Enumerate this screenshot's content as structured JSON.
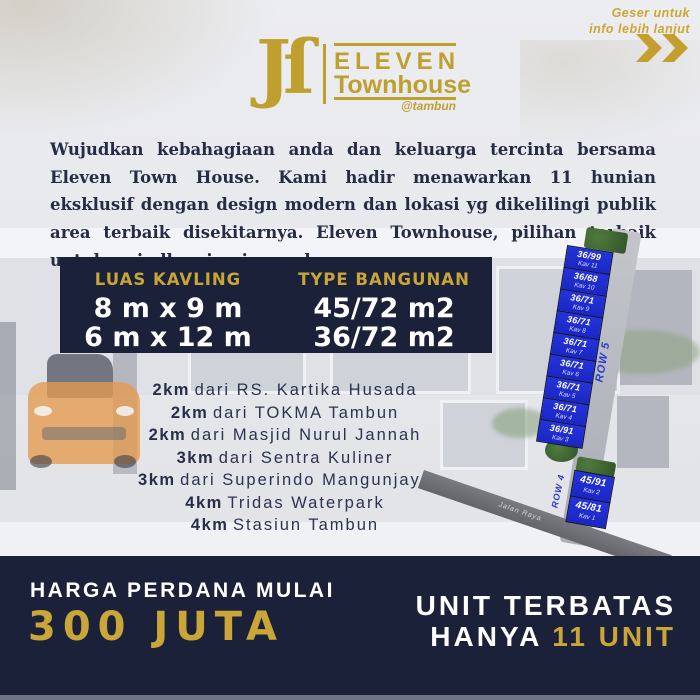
{
  "swipe_hint": {
    "line1": "Geser untuk",
    "line2": "info lebih lanjut"
  },
  "logo": {
    "mark": "Jſ",
    "name": "ELEVEN",
    "subname": "Townhouse",
    "handle": "@tambun"
  },
  "intro": "Wujudkan kebahagiaan anda dan keluarga tercinta bersama Eleven Town House. Kami hadir menawarkan 11 hunian eksklusif dengan design modern dan lokasi yg dikelilingi publik area terbaik disekitarnya. Eleven Townhouse, pilihan terbaik untuk wujudkan impian anda.",
  "specs": {
    "luas_title": "LUAS KAVLING",
    "luas_value1": "8 m x 9 m",
    "luas_value2": "6 m x 12 m",
    "type_title": "TYPE BANGUNAN",
    "type_value1": "45/72 m2",
    "type_value2": "36/72 m2"
  },
  "distances": [
    {
      "km": "2km",
      "place": "dari RS. Kartika Husada"
    },
    {
      "km": "2km",
      "place": "dari TOKMA Tambun"
    },
    {
      "km": "2km",
      "place": "dari Masjid Nurul Jannah"
    },
    {
      "km": "3km",
      "place": "dari Sentra Kuliner"
    },
    {
      "km": "3km",
      "place": "dari Superindo Mangunjaya"
    },
    {
      "km": "4km",
      "place": "Tridas Waterpark"
    },
    {
      "km": "4km",
      "place": "Stasiun Tambun"
    }
  ],
  "siteplan": {
    "row5_label": "ROW 5",
    "row4_label": "ROW 4",
    "road_label": "Jalan Raya",
    "plots_main": [
      {
        "type": "36/99",
        "kav": "Kav 11"
      },
      {
        "type": "36/68",
        "kav": "Kav 10"
      },
      {
        "type": "36/71",
        "kav": "Kav 9"
      },
      {
        "type": "36/71",
        "kav": "Kav 8"
      },
      {
        "type": "36/71",
        "kav": "Kav 7"
      },
      {
        "type": "36/71",
        "kav": "Kav 6"
      },
      {
        "type": "36/71",
        "kav": "Kav 5"
      },
      {
        "type": "36/71",
        "kav": "Kav 4"
      },
      {
        "type": "36/91",
        "kav": "Kav 3"
      }
    ],
    "plots_front": [
      {
        "type": "45/91",
        "kav": "Kav 2"
      },
      {
        "type": "45/81",
        "kav": "Kav 1"
      }
    ]
  },
  "footer": {
    "price_label": "HARGA PERDANA MULAI",
    "price_value": "300 JUTA",
    "units_line1": "UNIT TERBATAS",
    "units_line2_white": "HANYA",
    "units_line2_gold": "11 UNIT"
  },
  "colors": {
    "gold": "#c6a233",
    "navy": "#1b2138",
    "plot_blue": "#1f2ccd",
    "road_gray": "#6d6f75"
  }
}
